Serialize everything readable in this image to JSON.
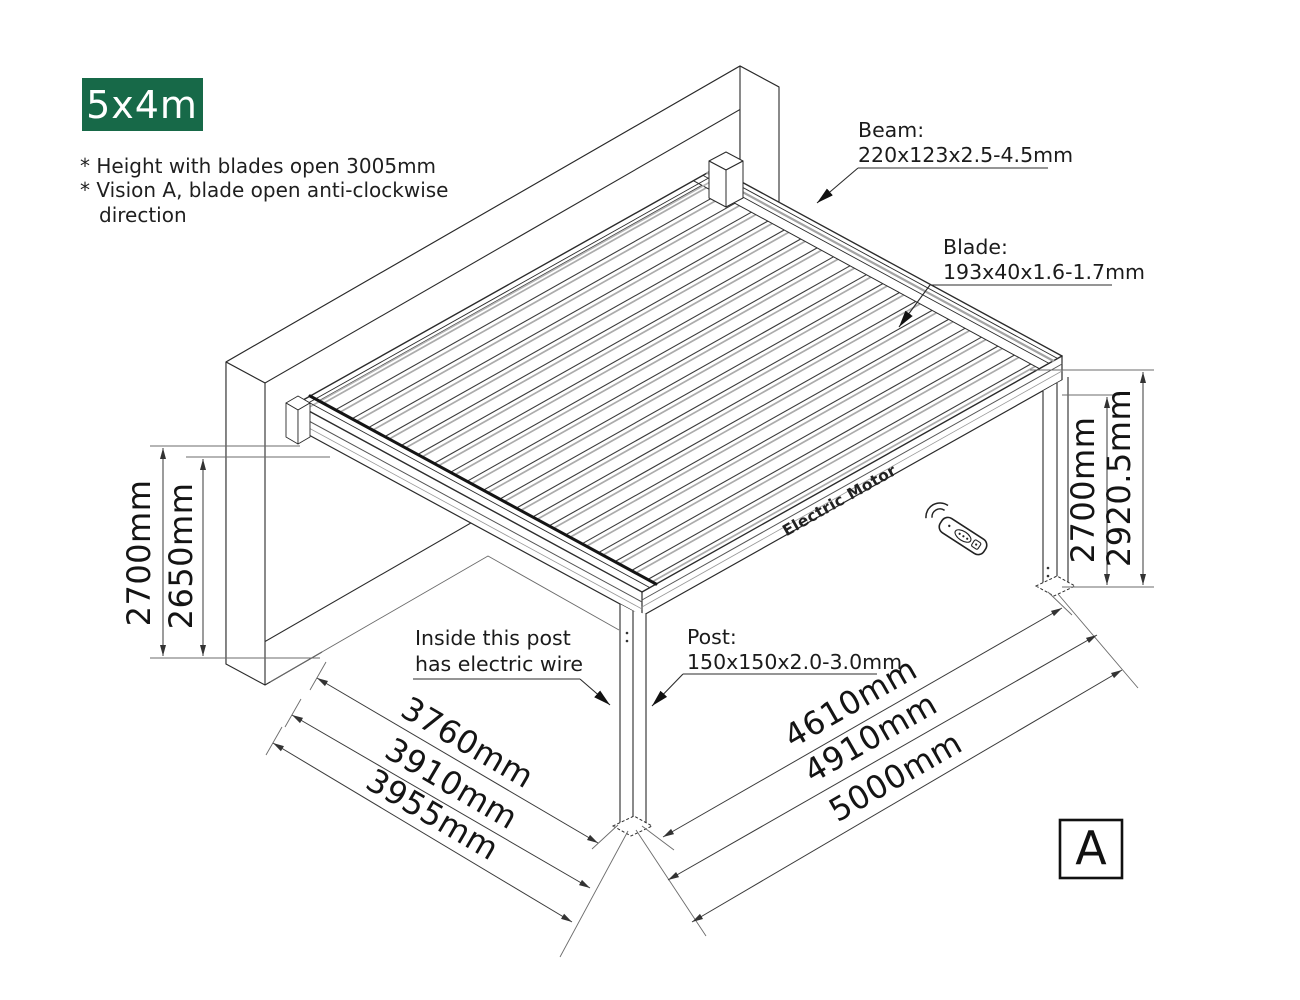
{
  "badge": {
    "label": "5x4m"
  },
  "notes": {
    "line1": "* Height with blades open 3005mm",
    "line2": "* Vision A, blade open anti-clockwise",
    "line3": "direction"
  },
  "callouts": {
    "beam_title": "Beam:",
    "beam_spec": "220x123x2.5-4.5mm",
    "blade_title": "Blade:",
    "blade_spec": "193x40x1.6-1.7mm",
    "post_title": "Post:",
    "post_spec": "150x150x2.0-3.0mm",
    "wire_line1": "Inside this post",
    "wire_line2": "has electric wire",
    "motor_label": "Electric Motor"
  },
  "dimensions": {
    "left_outer": "2700mm",
    "left_inner": "2650mm",
    "right_inner": "2700mm",
    "right_outer": "2920.5mm",
    "front_1": "3760mm",
    "front_2": "3910mm",
    "front_3": "3955mm",
    "side_1": "4610mm",
    "side_2": "4910mm",
    "side_3": "5000mm"
  },
  "view_marker": "A",
  "icons": {
    "remote": "remote-control-icon",
    "signal": "wireless-signal-icon"
  },
  "colors": {
    "badge_bg": "#176948",
    "line": "#2b2b2b",
    "secondary_line": "#a3a3a3",
    "gutter_dark": "#141414"
  }
}
